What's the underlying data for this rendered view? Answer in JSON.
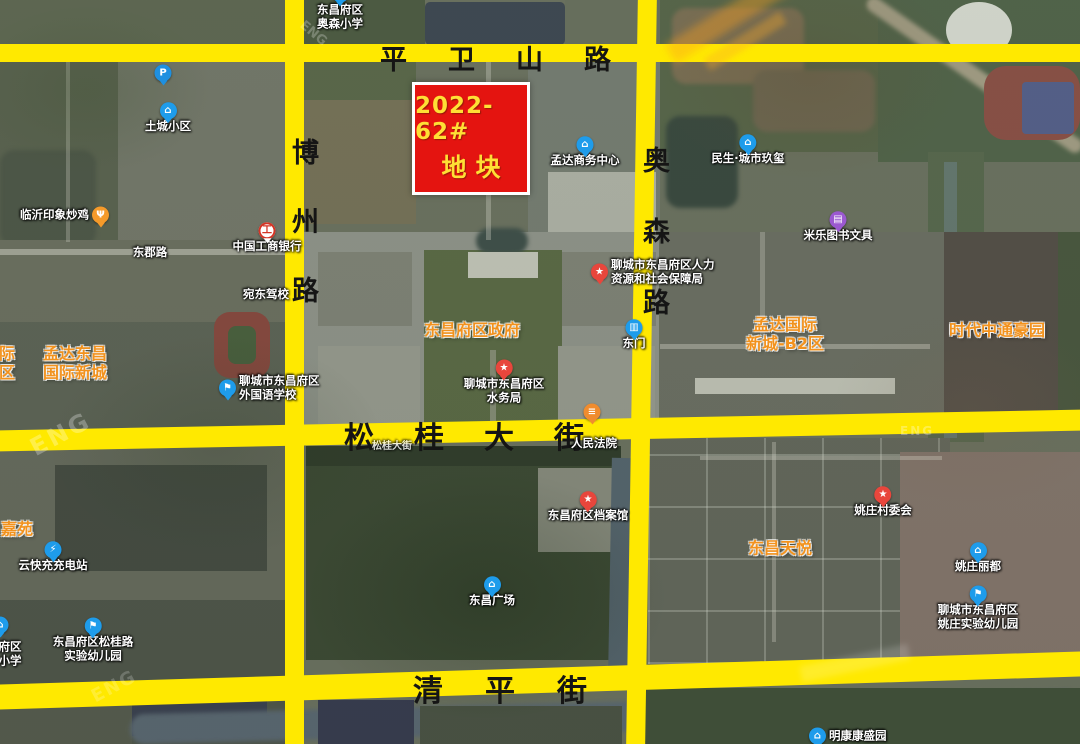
{
  "colors": {
    "road": "#ffe900",
    "parcel_fill": "#e41410",
    "parcel_border": "#ffffff",
    "parcel_text": "#ffdf35",
    "orange_label": "#f2921d"
  },
  "parcel": {
    "line1": "2022-62#",
    "line2": "地块"
  },
  "roads": {
    "pingweishan": {
      "name": "平卫山路"
    },
    "bozhou": {
      "name": "博州路"
    },
    "aosen": {
      "name": "奥森路"
    },
    "songgui": {
      "name": "松桂大街"
    },
    "qingping": {
      "name": "清平街"
    }
  },
  "watermark": {
    "fragment": "ENG"
  },
  "pois": [
    {
      "name": "parking-poi",
      "icon": "parking",
      "icon_color": "#1e90e0",
      "x": 163,
      "y": 73,
      "lines": [],
      "pos": "below",
      "cls": "w"
    },
    {
      "name": "tucheng-xiaoqu",
      "icon": "building",
      "icon_color": "#1e9ceb",
      "x": 168,
      "y": 118,
      "lines": [
        "土城小区"
      ],
      "pos": "below",
      "cls": "w"
    },
    {
      "name": "aosen-primary-school",
      "icon": "school",
      "icon_color": "#1e9ceb",
      "x": 340,
      "y": 8,
      "lines": [
        "东昌府区",
        "奥森小学"
      ],
      "pos": "below",
      "cls": "w",
      "under": true
    },
    {
      "name": "linyi-yinxiang-chaoji",
      "icon": "food",
      "icon_color": "#f59a2a",
      "x": 99,
      "y": 215,
      "lines": [
        "临沂印象炒鸡"
      ],
      "pos": "left",
      "cls": "w"
    },
    {
      "name": "dongjun-road-label",
      "icon": null,
      "icon_color": "",
      "x": 150,
      "y": 253,
      "lines": [
        "东郡路"
      ],
      "pos": "center",
      "cls": "w"
    },
    {
      "name": "icbc-bank",
      "icon": "bank",
      "icon_color": "#ffffff",
      "x": 267,
      "y": 238,
      "lines": [
        "中国工商银行"
      ],
      "pos": "below",
      "cls": "w"
    },
    {
      "name": "wandong-driving-school",
      "icon": null,
      "icon_color": "",
      "x": 266,
      "y": 295,
      "lines": [
        "宛东驾校"
      ],
      "pos": "center",
      "cls": "w"
    },
    {
      "name": "mengda-business-center",
      "icon": "building",
      "icon_color": "#1e9ceb",
      "x": 585,
      "y": 152,
      "lines": [
        "孟达商务中心"
      ],
      "pos": "below",
      "cls": "w"
    },
    {
      "name": "minsheng-chengshi-jiuxi",
      "icon": "building",
      "icon_color": "#1e9ceb",
      "x": 748,
      "y": 150,
      "lines": [
        "民生·城市玖玺"
      ],
      "pos": "below",
      "cls": "w"
    },
    {
      "name": "mile-books-stationery",
      "icon": "book",
      "icon_color": "#9b59d0",
      "x": 838,
      "y": 227,
      "lines": [
        "米乐图书文具"
      ],
      "pos": "below",
      "cls": "w"
    },
    {
      "name": "hr-social-security-bureau",
      "icon": "star",
      "icon_color": "#e8463c",
      "x": 600,
      "y": 272,
      "lines": [
        "聊城市东昌府区人力",
        "资源和社会保障局"
      ],
      "pos": "right",
      "cls": "w"
    },
    {
      "name": "district-government-label",
      "icon": null,
      "icon_color": "",
      "x": 472,
      "y": 331,
      "lines": [
        "东昌府区政府"
      ],
      "pos": "center",
      "cls": "o"
    },
    {
      "name": "mengda-dongchang-intl",
      "icon": null,
      "icon_color": "",
      "x": 75,
      "y": 364,
      "lines": [
        "孟达东昌",
        "国际新城"
      ],
      "pos": "center",
      "cls": "o"
    },
    {
      "name": "left-edge-partial-label",
      "icon": null,
      "icon_color": "",
      "x": 7,
      "y": 364,
      "lines": [
        "际",
        "区"
      ],
      "pos": "center",
      "cls": "o"
    },
    {
      "name": "foreign-language-school",
      "icon": "school",
      "icon_color": "#1e9ceb",
      "x": 228,
      "y": 388,
      "lines": [
        "聊城市东昌府区",
        "外国语学校"
      ],
      "pos": "right",
      "cls": "w"
    },
    {
      "name": "east-gate",
      "icon": "gate",
      "icon_color": "#1e9ceb",
      "x": 634,
      "y": 335,
      "lines": [
        "东门"
      ],
      "pos": "below",
      "cls": "w"
    },
    {
      "name": "water-affairs-bureau",
      "icon": "star",
      "icon_color": "#e8463c",
      "x": 504,
      "y": 382,
      "lines": [
        "聊城市东昌府区",
        "水务局"
      ],
      "pos": "below",
      "cls": "w"
    },
    {
      "name": "court-poi",
      "icon": "court",
      "icon_color": "#f08c2e",
      "x": 592,
      "y": 412,
      "lines": [],
      "pos": "below",
      "cls": "w"
    },
    {
      "name": "peoples-court-label",
      "icon": null,
      "icon_color": "",
      "x": 594,
      "y": 444,
      "lines": [
        "人民法院"
      ],
      "pos": "center",
      "cls": "w"
    },
    {
      "name": "songgui-basemap-label",
      "icon": null,
      "icon_color": "",
      "x": 392,
      "y": 447,
      "lines": [
        "松桂大街"
      ],
      "pos": "center",
      "cls": "wf"
    },
    {
      "name": "district-archives",
      "icon": "star",
      "icon_color": "#e8463c",
      "x": 588,
      "y": 507,
      "lines": [
        "东昌府区档案馆"
      ],
      "pos": "below",
      "cls": "w"
    },
    {
      "name": "dongchang-plaza",
      "icon": "plaza",
      "icon_color": "#1e9ceb",
      "x": 492,
      "y": 592,
      "lines": [
        "东昌广场"
      ],
      "pos": "below",
      "cls": "w"
    },
    {
      "name": "yaozhuang-village-committee",
      "icon": "star",
      "icon_color": "#e8463c",
      "x": 883,
      "y": 502,
      "lines": [
        "姚庄村委会"
      ],
      "pos": "below",
      "cls": "w"
    },
    {
      "name": "dongchang-tianyue",
      "icon": null,
      "icon_color": "",
      "x": 780,
      "y": 549,
      "lines": [
        "东昌天悦"
      ],
      "pos": "center",
      "cls": "o"
    },
    {
      "name": "yaozhuang-lidu",
      "icon": "building",
      "icon_color": "#1e9ceb",
      "x": 978,
      "y": 558,
      "lines": [
        "姚庄丽都"
      ],
      "pos": "below",
      "cls": "w"
    },
    {
      "name": "yaozhuang-kindergarten",
      "icon": "school",
      "icon_color": "#1e9ceb",
      "x": 978,
      "y": 608,
      "lines": [
        "聊城市东昌府区",
        "姚庄实验幼儿园"
      ],
      "pos": "below",
      "cls": "w"
    },
    {
      "name": "mingkang-kangshengyuan",
      "icon": "building",
      "icon_color": "#1e9ceb",
      "x": 818,
      "y": 736,
      "lines": [
        "明康康盛园"
      ],
      "pos": "right",
      "cls": "w"
    },
    {
      "name": "jiayuan-label",
      "icon": null,
      "icon_color": "",
      "x": 17,
      "y": 530,
      "lines": [
        "嘉苑"
      ],
      "pos": "center",
      "cls": "o"
    },
    {
      "name": "yunkuaichong-charging",
      "icon": "charge",
      "icon_color": "#1e9ceb",
      "x": 53,
      "y": 557,
      "lines": [
        "云快充充电站"
      ],
      "pos": "below",
      "cls": "w"
    },
    {
      "name": "left-edge-poi",
      "icon": "building",
      "icon_color": "#1e9ceb",
      "x": 0,
      "y": 625,
      "lines": [],
      "pos": "below",
      "cls": "w"
    },
    {
      "name": "left-partial-school-label",
      "icon": null,
      "icon_color": "",
      "x": 10,
      "y": 654,
      "lines": [
        "府区",
        "小学"
      ],
      "pos": "center",
      "cls": "w"
    },
    {
      "name": "songgui-road-kindergarten",
      "icon": "school",
      "icon_color": "#1e9ceb",
      "x": 93,
      "y": 640,
      "lines": [
        "东昌府区松桂路",
        "实验幼儿园"
      ],
      "pos": "below",
      "cls": "w"
    },
    {
      "name": "mengda-intl-b2",
      "icon": null,
      "icon_color": "",
      "x": 785,
      "y": 335,
      "lines": [
        "孟达国际",
        "新城-B2区"
      ],
      "pos": "center",
      "cls": "o"
    },
    {
      "name": "shidai-zhongtong-haoyuan",
      "icon": null,
      "icon_color": "",
      "x": 997,
      "y": 331,
      "lines": [
        "时代中通豪园"
      ],
      "pos": "center",
      "cls": "o"
    }
  ]
}
